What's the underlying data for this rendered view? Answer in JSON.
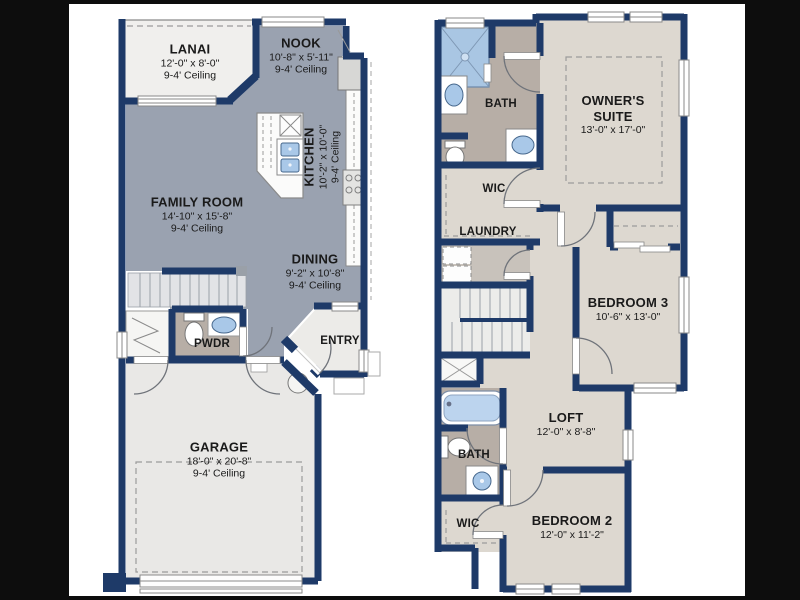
{
  "colors": {
    "background": "#0d0d0d",
    "canvas": "#ffffff",
    "wall_navy": "#1e3a68",
    "living_gray": "#9aa2b0",
    "bedroom_beige": "#ddd8d0",
    "bath_taupe": "#b7aea6",
    "laundry_gray": "#c8c2bb",
    "outdoor_light": "#f0efed",
    "garage_light": "#e9e8e6",
    "fixture_blue": "#a9c8e8",
    "shower_blue": "#a9c6e3",
    "tub_blue": "#bcd4ee"
  },
  "floor1": {
    "rooms": {
      "lanai": {
        "name": "LANAI",
        "dims": "12'-0\" x 8'-0\"",
        "ceiling": "9-4' Ceiling"
      },
      "nook": {
        "name": "NOOK",
        "dims": "10'-8\" x 5'-11\"",
        "ceiling": "9-4' Ceiling"
      },
      "kitchen": {
        "name": "KITCHEN",
        "dims": "10'-2\" x 10'-0\"",
        "ceiling": "9-4' Ceiling"
      },
      "family": {
        "name": "FAMILY ROOM",
        "dims": "14'-10\" x 15'-8\"",
        "ceiling": "9-4' Ceiling"
      },
      "dining": {
        "name": "DINING",
        "dims": "9'-2\" x 10'-8\"",
        "ceiling": "9-4' Ceiling"
      },
      "pwdr": {
        "name": "PWDR"
      },
      "entry": {
        "name": "ENTRY"
      },
      "garage": {
        "name": "GARAGE",
        "dims": "18'-0\" x 20'-8\"",
        "ceiling": "9-4' Ceiling"
      }
    }
  },
  "floor2": {
    "rooms": {
      "bath": {
        "name": "BATH"
      },
      "owners": {
        "name": "OWNER'S SUITE",
        "dims": "13'-0\" x 17'-0\""
      },
      "wic": {
        "name": "WIC"
      },
      "laundry": {
        "name": "LAUNDRY"
      },
      "bedroom3": {
        "name": "BEDROOM 3",
        "dims": "10'-6\" x 13'-0\""
      },
      "loft": {
        "name": "LOFT",
        "dims": "12'-0\" x 8'-8\""
      },
      "bath2": {
        "name": "BATH"
      },
      "wic2": {
        "name": "WIC"
      },
      "bedroom2": {
        "name": "BEDROOM 2",
        "dims": "12'-0\" x 11'-2\""
      }
    }
  }
}
